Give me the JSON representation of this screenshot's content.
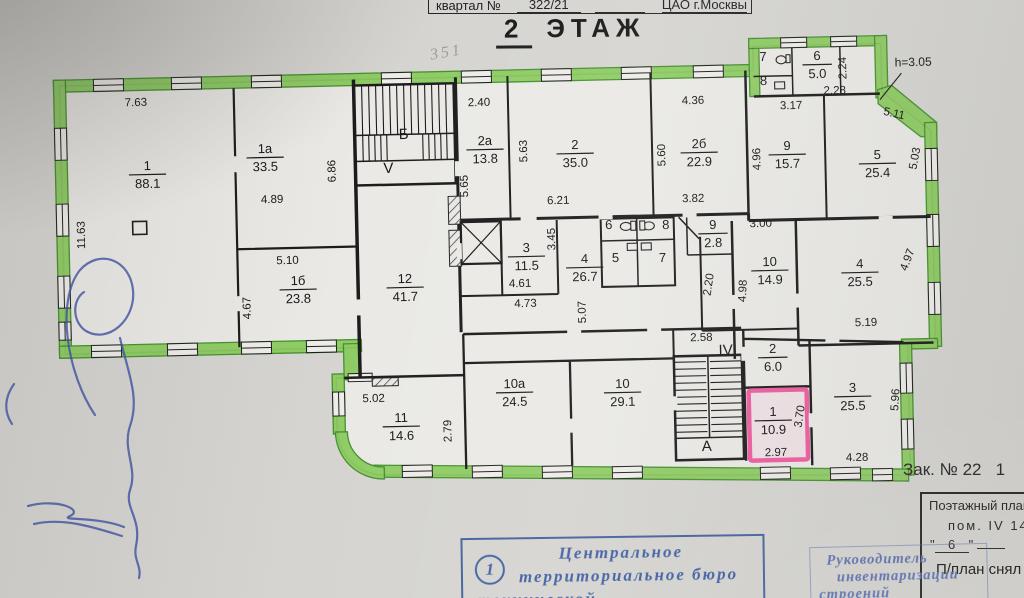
{
  "header": {
    "quarter_label": "квартал №",
    "quarter_value": "322/21",
    "district": "ЦАО г.Москвы",
    "title_number": "2",
    "title_word": "ЭТАЖ",
    "pencil_note": "351"
  },
  "watermark": {
    "brand": "PRÆDIUM",
    "subtitle": "КОММЕРЧЕСКАЯ НЕДВИЖИМОСТЬ"
  },
  "plan": {
    "height_note": "h=3.05",
    "colors": {
      "wall_highlight": "#8bcb5f",
      "selected_room_outline": "#ee5c9e",
      "red_label": "#c13828",
      "pen_ink": "#3d51a5",
      "stamp_blue": "#41619f"
    },
    "rooms": [
      {
        "num": "1",
        "area": "88.1",
        "x": 150,
        "y": 174
      },
      {
        "num": "1а",
        "area": "33.5",
        "x": 268,
        "y": 157
      },
      {
        "num": "1б",
        "area": "23.8",
        "x": 298,
        "y": 289
      },
      {
        "num": "12",
        "area": "41.7",
        "x": 405,
        "y": 287
      },
      {
        "num": "2а",
        "area": "13.8",
        "x": 488,
        "y": 149
      },
      {
        "num": "2",
        "area": "35.0",
        "x": 578,
        "y": 153
      },
      {
        "num": "2б",
        "area": "22.9",
        "x": 702,
        "y": 152
      },
      {
        "num": "9",
        "area": "15.7",
        "x": 790,
        "y": 154
      },
      {
        "num": "5",
        "area": "25.4",
        "x": 880,
        "y": 163
      },
      {
        "num": "6",
        "area": "5.0",
        "x": 822,
        "y": 64
      },
      {
        "num": "3",
        "area": "11.5",
        "x": 527,
        "y": 256
      },
      {
        "num": "4",
        "area": "26.7",
        "x": 585,
        "y": 267
      },
      {
        "num": "9",
        "area": "2.8",
        "x": 714,
        "y": 233
      },
      {
        "num": "10",
        "area": "14.9",
        "x": 770,
        "y": 270
      },
      {
        "num": "4",
        "area": "25.5",
        "x": 860,
        "y": 272
      },
      {
        "num": "11",
        "area": "14.6",
        "x": 398,
        "y": 426
      },
      {
        "num": "10а",
        "area": "24.5",
        "x": 512,
        "y": 392
      },
      {
        "num": "10",
        "area": "29.1",
        "x": 620,
        "y": 392
      },
      {
        "num": "2",
        "area": "6.0",
        "x": 771,
        "y": 357
      },
      {
        "num": "1",
        "area": "10.9",
        "x": 770,
        "y": 420,
        "pink": true
      },
      {
        "num": "3",
        "area": "25.5",
        "x": 850,
        "y": 396
      }
    ],
    "small_rooms": [
      {
        "num": "7",
        "x": 768,
        "y": 61
      },
      {
        "num": "8",
        "x": 768,
        "y": 85
      },
      {
        "num": "6",
        "x": 610,
        "y": 229
      },
      {
        "num": "8",
        "x": 667,
        "y": 229
      },
      {
        "num": "5",
        "x": 616,
        "y": 262
      },
      {
        "num": "7",
        "x": 663,
        "y": 262
      }
    ],
    "dims": [
      {
        "t": "7.63",
        "x": 140,
        "y": 106
      },
      {
        "t": "11.63",
        "x": 86,
        "y": 235,
        "r": -90
      },
      {
        "t": "4.89",
        "x": 274,
        "y": 203
      },
      {
        "t": "6.86",
        "x": 338,
        "y": 171,
        "r": -90
      },
      {
        "t": "5.10",
        "x": 288,
        "y": 264
      },
      {
        "t": "4.67",
        "x": 250,
        "y": 308,
        "r": -90
      },
      {
        "t": "2.40",
        "x": 483,
        "y": 106
      },
      {
        "t": "5.65",
        "x": 470,
        "y": 186,
        "r": -90
      },
      {
        "t": "5.63",
        "x": 530,
        "y": 151,
        "r": -90
      },
      {
        "t": "6.21",
        "x": 560,
        "y": 204
      },
      {
        "t": "4.36",
        "x": 697,
        "y": 104
      },
      {
        "t": "5.60",
        "x": 668,
        "y": 155,
        "r": -90
      },
      {
        "t": "3.82",
        "x": 695,
        "y": 202
      },
      {
        "t": "3.17",
        "x": 795,
        "y": 109
      },
      {
        "t": "4.96",
        "x": 763,
        "y": 159,
        "r": -90
      },
      {
        "t": "2.28",
        "x": 839,
        "y": 94
      },
      {
        "t": "2.24",
        "x": 851,
        "y": 68,
        "r": -90
      },
      {
        "t": "5.11",
        "x": 897,
        "y": 117,
        "r": 14
      },
      {
        "t": "5.03",
        "x": 921,
        "y": 159,
        "r": -78
      },
      {
        "t": "3.45",
        "x": 556,
        "y": 239,
        "r": -90
      },
      {
        "t": "4.61",
        "x": 520,
        "y": 287
      },
      {
        "t": "4.73",
        "x": 525,
        "y": 307
      },
      {
        "t": "5.07",
        "x": 585,
        "y": 312,
        "r": -90
      },
      {
        "t": "3.00",
        "x": 762,
        "y": 227
      },
      {
        "t": "4.98",
        "x": 746,
        "y": 291,
        "r": -86
      },
      {
        "t": "2.20",
        "x": 712,
        "y": 285,
        "r": -80
      },
      {
        "t": "4.97",
        "x": 911,
        "y": 261,
        "r": -68
      },
      {
        "t": "5.19",
        "x": 865,
        "y": 326
      },
      {
        "t": "2.58",
        "x": 700,
        "y": 341
      },
      {
        "t": "5.02",
        "x": 371,
        "y": 402
      },
      {
        "t": "2.79",
        "x": 448,
        "y": 431,
        "r": -90
      },
      {
        "t": "2.97",
        "x": 772,
        "y": 456
      },
      {
        "t": "3.70",
        "x": 800,
        "y": 417,
        "r": -80
      },
      {
        "t": "4.28",
        "x": 853,
        "y": 461
      },
      {
        "t": "5.96",
        "x": 896,
        "y": 400,
        "r": -85
      }
    ],
    "letters": [
      {
        "t": "Б",
        "x": 407,
        "y": 139
      },
      {
        "t": "V",
        "x": 391,
        "y": 173,
        "red": true
      },
      {
        "t": "IV",
        "x": 724,
        "y": 355,
        "red": true
      },
      {
        "t": "А",
        "x": 703,
        "y": 451
      }
    ]
  },
  "footer": {
    "order_no": "Зак. № 22   1",
    "form_title": "Поэтажный план о",
    "form_room": "пом.  IV    14.",
    "form_quote_open": "\"",
    "form_quote_num": "6",
    "form_quote_close": "\"",
    "form_filed": "П/план снял"
  },
  "stamps": {
    "center": {
      "badge": "1",
      "line1": "Центральное",
      "line2": "территориальное бюро",
      "line3": "технической"
    },
    "right": {
      "line1": "Руководитель",
      "line2": "инвентаризации",
      "line3": "строений"
    }
  }
}
